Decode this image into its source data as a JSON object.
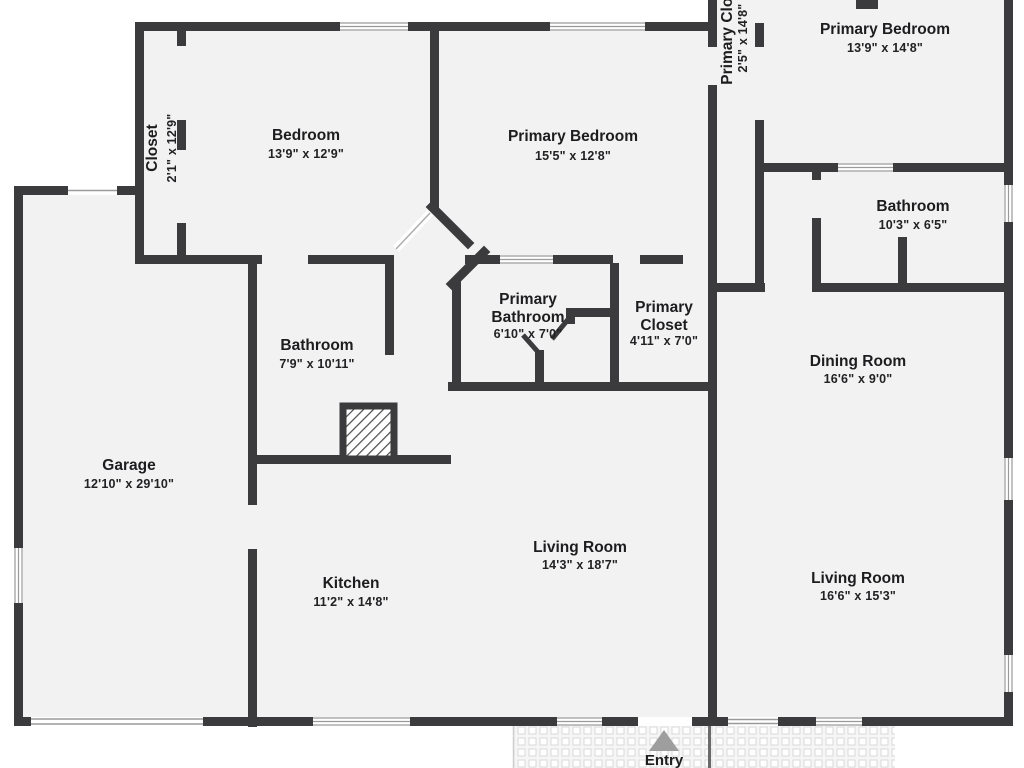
{
  "plan": {
    "rooms": [
      {
        "id": "closet-left",
        "name": "Closet",
        "dims": "2'1\" x 12'9\""
      },
      {
        "id": "bedroom",
        "name": "Bedroom",
        "dims": "13'9\" x 12'9\""
      },
      {
        "id": "primary-bedroom-center",
        "name": "Primary Bedroom",
        "dims": "15'5\" x 12'8\""
      },
      {
        "id": "primary-closet-top",
        "name": "Primary Closet",
        "dims": "2'5\" x 14'8\""
      },
      {
        "id": "primary-bedroom-right",
        "name": "Primary Bedroom",
        "dims": "13'9\" x 14'8\""
      },
      {
        "id": "bathroom-right",
        "name": "Bathroom",
        "dims": "10'3\" x 6'5\""
      },
      {
        "id": "primary-bathroom",
        "name": "Primary Bathroom",
        "lines": [
          "Primary",
          "Bathroom"
        ],
        "dims": "6'10\" x 7'0\""
      },
      {
        "id": "primary-closet-mid",
        "name": "Primary Closet",
        "lines": [
          "Primary",
          "Closet"
        ],
        "dims": "4'11\" x 7'0\""
      },
      {
        "id": "bathroom-left",
        "name": "Bathroom",
        "dims": "7'9\" x 10'11\""
      },
      {
        "id": "garage",
        "name": "Garage",
        "dims": "12'10\" x 29'10\""
      },
      {
        "id": "kitchen",
        "name": "Kitchen",
        "dims": "11'2\" x 14'8\""
      },
      {
        "id": "living-room-center",
        "name": "Living Room",
        "dims": "14'3\" x 18'7\""
      },
      {
        "id": "dining-room",
        "name": "Dining Room",
        "dims": "16'6\" x 9'0\""
      },
      {
        "id": "living-room-right",
        "name": "Living Room",
        "dims": "16'6\" x 15'3\""
      }
    ],
    "entry_label": "Entry",
    "colors": {
      "wall": "#3b3b3d",
      "floor": "#f2f2f3",
      "window_line": "#9a9a9a",
      "entry_arrow": "#9e9e9e",
      "text": "#1d1d1f"
    }
  }
}
